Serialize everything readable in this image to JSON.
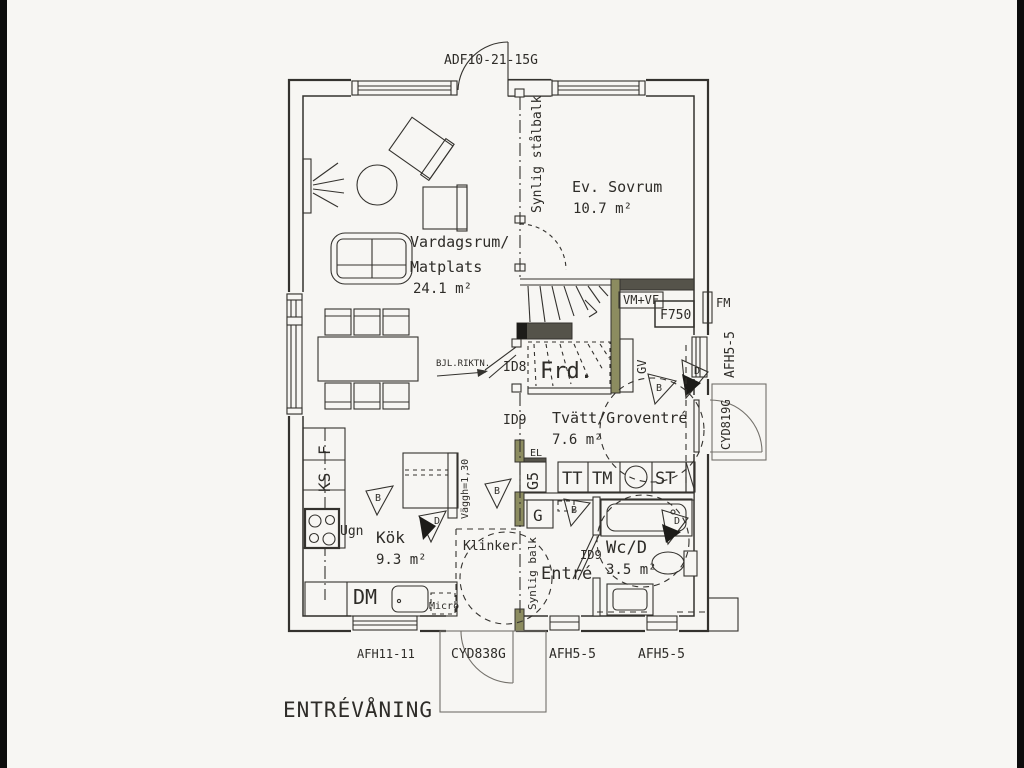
{
  "title": "ENTRÉVÅNING",
  "colors": {
    "line": "#34322e",
    "paper": "#f7f6f3",
    "olive_wall": "#8c8c60",
    "dark_wall": "#55534a",
    "edge_bar": "#0c0c0c"
  },
  "rooms": {
    "living": {
      "line1": "Vardagsrum/",
      "line2": "Matplats",
      "area": "24.1 m²"
    },
    "bedroom": {
      "name": "Ev. Sovrum",
      "area": "10.7 m²"
    },
    "kitchen": {
      "name": "Kök",
      "area": "9.3 m²"
    },
    "laundry": {
      "name": "Tvätt/Groventré",
      "area": "7.6 m²"
    },
    "wc": {
      "name": "Wc/D",
      "area": "3.5 m²"
    },
    "entry": {
      "name": "Entré"
    },
    "storage": {
      "name": "Frd."
    }
  },
  "codes": {
    "patio_door": "ADF10-21-15G",
    "kitchen_window": "AFH11-11",
    "entry_door": "CYD838G",
    "entry_window": "AFH5-5",
    "wc_window": "AFH5-5",
    "right_window": "AFH5-5",
    "right_door": "CYD819G"
  },
  "annotations": {
    "steel_beam": "Synlig stålbalk",
    "beam": "Synlig balk",
    "beam_direction": "BJL.RIKTN.",
    "half_wall": "Väggh=1,30",
    "floor_tiles": "Klinker",
    "el": "EL",
    "gv": "GV",
    "fm": "FM",
    "vm_vf": "VM+VF",
    "water_heater": "F750",
    "id8": "ID8",
    "id9": "ID9",
    "id9_wc": "ID9"
  },
  "fixtures": {
    "fridge": "F",
    "fridge_freezer": "KS",
    "oven": "Ugn",
    "dishwasher": "DM",
    "micro": "Micro",
    "dryer": "TT",
    "washer": "TM",
    "cleaning": "ST",
    "wardrobe_g5": "G5",
    "wardrobe_g": "G"
  },
  "markers": {
    "b": "B",
    "d": "D"
  }
}
